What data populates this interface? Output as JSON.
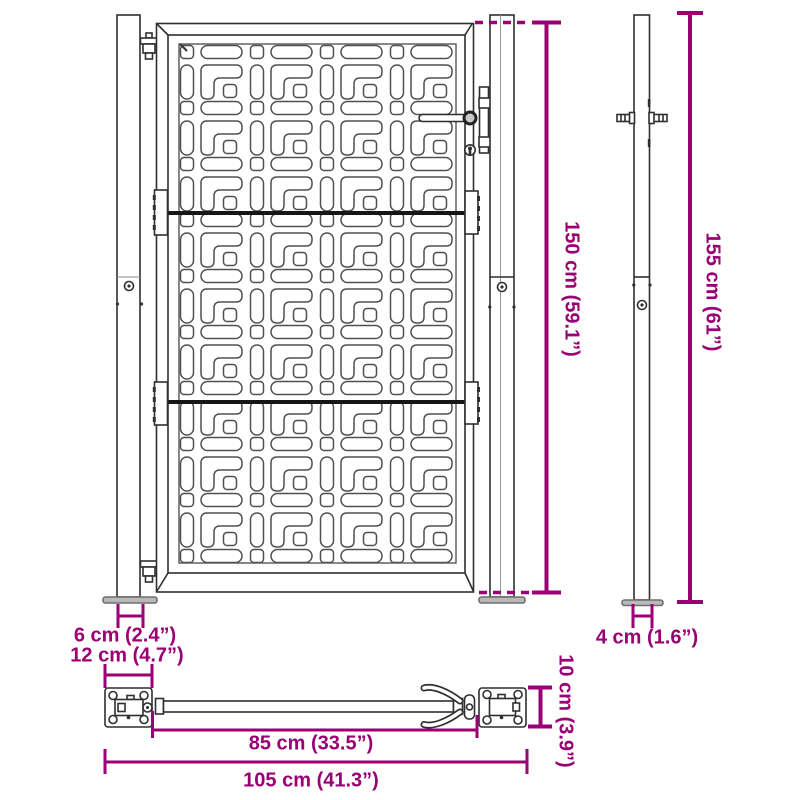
{
  "drawing": "garden-gate-dimension-diagram",
  "colors": {
    "accent": "#9a0074",
    "line": "#2f2f2f",
    "pattern_line": "#4f4f4f",
    "plate_fill": "#b9b9b9"
  },
  "dimensions": {
    "gate_height": {
      "label": "150 cm (59.1”)",
      "orientation": "vertical"
    },
    "post_height": {
      "label": "155 cm (61”)",
      "orientation": "vertical"
    },
    "post_offset": {
      "label": "6 cm (2.4”)",
      "orientation": "horizontal"
    },
    "plate_width": {
      "label": "12 cm (4.7”)",
      "orientation": "horizontal"
    },
    "post_width": {
      "label": "4 cm (1.6”)",
      "orientation": "horizontal"
    },
    "frame_depth": {
      "label": "10 cm (3.9”)",
      "orientation": "vertical"
    },
    "inner_width": {
      "label": "85 cm (33.5”)",
      "orientation": "horizontal"
    },
    "total_width": {
      "label": "105 cm (41.3”)",
      "orientation": "horizontal"
    }
  }
}
